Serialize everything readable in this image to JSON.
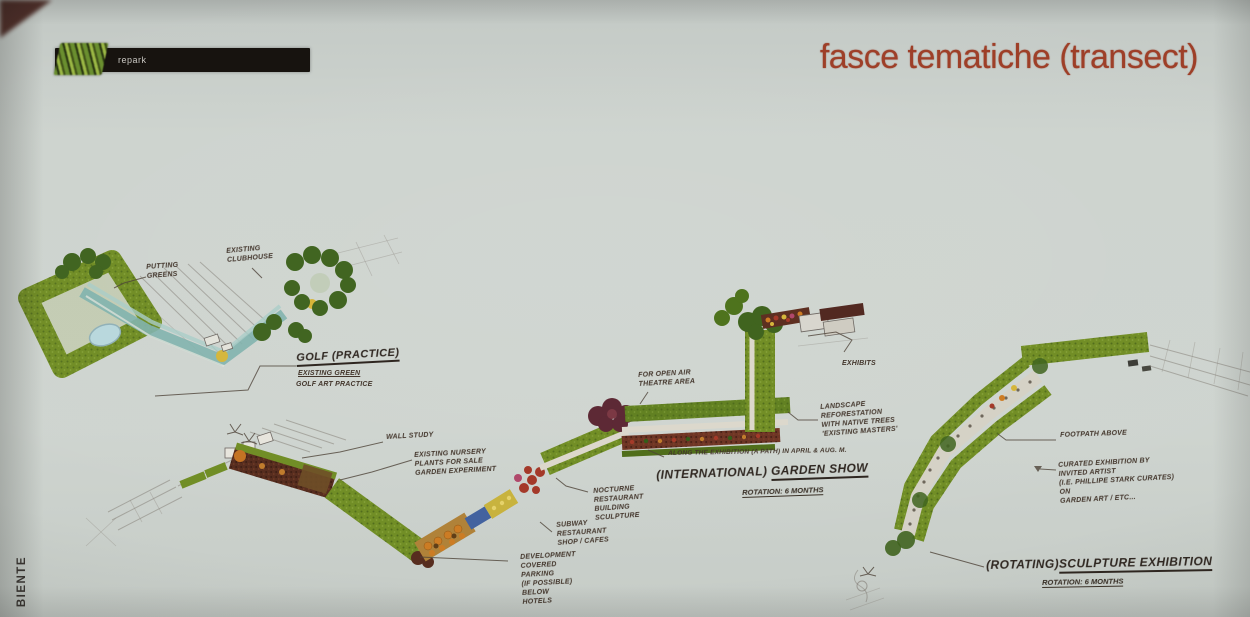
{
  "page": {
    "title": "fasce tematiche (transect)",
    "logo_text": "repark",
    "side_text": "BIENTE"
  },
  "colors": {
    "background": "#cbd1cc",
    "title_text": "#9e3f28",
    "logo_bar": "#17130f",
    "logo_green": "#6a8f2f",
    "band_green": "#6f8c21",
    "band_dark_green": "#3c611a",
    "lawn_green": "#5f7f1d",
    "teal": "#7fb3ad",
    "pond_blue": "#b9d9de",
    "planting_maroon": "#54281a",
    "planting_orange": "#c4701f",
    "planting_red": "#a33524",
    "planting_yellow": "#d6b637",
    "gravel": "#d6d2c6",
    "pencil": "#7d7770",
    "ink": "#43362c"
  },
  "plans": {
    "golf": {
      "label": "GOLF (PRACTICE)",
      "sub1": "EXISTING GREEN",
      "sub2": "GOLF ART PRACTICE",
      "callout_putting": "PUTTING\nGREENS",
      "callout_clubhouse": "EXISTING\nCLUBHOUSE"
    },
    "garden": {
      "label_prefix": "(INTERNATIONAL)",
      "label_main": "GARDEN SHOW",
      "label_sub": "ROTATION: 6 MONTHS",
      "note": "ALONG THE EXHIBITION (A PATH) IN APRIL & AUG. M.",
      "callout_wall": "WALL STUDY",
      "callout_nursery": "EXISTING NURSERY\nPLANTS FOR SALE\nGARDEN EXPERIMENT",
      "callout_theatre": "FOR OPEN AIR\nTHEATRE AREA",
      "callout_exhibits": "EXHIBITS",
      "callout_landscape": "LANDSCAPE\nREFORESTATION\nWITH NATIVE TREES\n'EXISTING MASTERS'",
      "callout_restaurant": "NOCTURNE\nRESTAURANT\nBUILDING\nSCULPTURE",
      "callout_subway": "SUBWAY\nRESTAURANT\nSHOP / CAFES",
      "callout_development": "DEVELOPMENT\nCOVERED\nPARKING\n(IF POSSIBLE)\nBELOW\nHOTELS"
    },
    "sculpture": {
      "label_prefix": "(ROTATING)",
      "label_main": "SCULPTURE EXHIBITION",
      "label_sub": "ROTATION: 6 MONTHS",
      "callout_footpath": "FOOTPATH ABOVE",
      "callout_curated": "CURATED EXHIBITION BY\nINVITED ARTIST\n(I.E. PHILLIPE STARK CURATES)\nON\nGARDEN ART / ETC..."
    }
  }
}
